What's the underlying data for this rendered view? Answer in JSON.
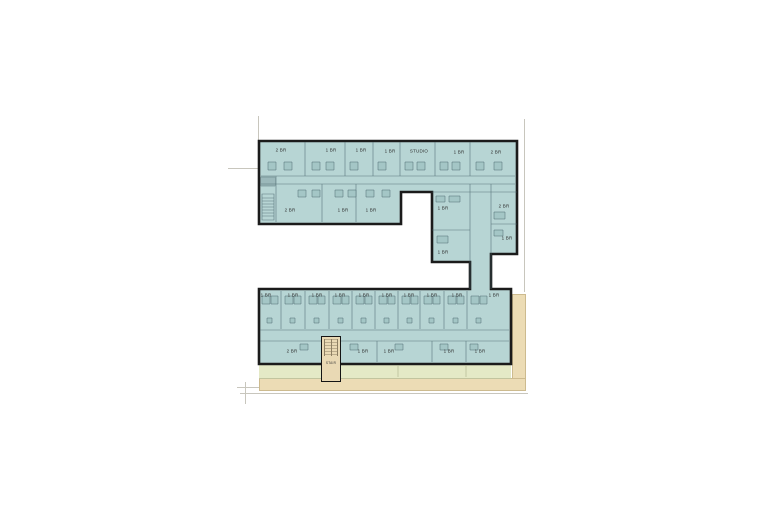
{
  "palette": {
    "unit": "#b7d5d4",
    "pod": "#a3c6c6",
    "wall": "#1b1b1b",
    "line": "#4a666d",
    "green": "#e4e9c6",
    "tan": "#ecdcb5",
    "stairTan": "#e9d9b4",
    "faint": "#c8c6bd",
    "label": "#2d2d2d"
  },
  "plan": {
    "stair": {
      "label": "STAIR",
      "x": 331,
      "y": 366
    },
    "units": [
      {
        "label": "2 BR",
        "row": "upper-north",
        "x": 281,
        "y": 150
      },
      {
        "label": "1 BR",
        "row": "upper-north",
        "x": 331,
        "y": 150
      },
      {
        "label": "1 BR",
        "row": "upper-north",
        "x": 361,
        "y": 150
      },
      {
        "label": "1 BR",
        "row": "upper-north",
        "x": 390,
        "y": 151
      },
      {
        "label": "STUDIO",
        "row": "upper-north",
        "x": 419,
        "y": 151
      },
      {
        "label": "1 BR",
        "row": "upper-north",
        "x": 459,
        "y": 152
      },
      {
        "label": "2 BR",
        "row": "upper-north",
        "x": 496,
        "y": 152
      },
      {
        "label": "2 BR",
        "row": "upper-south",
        "x": 290,
        "y": 210
      },
      {
        "label": "1 BR",
        "row": "upper-south",
        "x": 343,
        "y": 210
      },
      {
        "label": "1 BR",
        "row": "upper-south",
        "x": 371,
        "y": 210
      },
      {
        "label": "1 BR",
        "row": "east-wing",
        "x": 443,
        "y": 208
      },
      {
        "label": "2 BR",
        "row": "east-wing",
        "x": 504,
        "y": 206
      },
      {
        "label": "1 BR",
        "row": "east-wing",
        "x": 507,
        "y": 238
      },
      {
        "label": "1 BR",
        "row": "east-wing",
        "x": 443,
        "y": 252
      },
      {
        "label": "1 BR",
        "row": "lower-north",
        "x": 266,
        "y": 295
      },
      {
        "label": "1 BR",
        "row": "lower-north",
        "x": 293,
        "y": 295
      },
      {
        "label": "1 BR",
        "row": "lower-north",
        "x": 317,
        "y": 295
      },
      {
        "label": "1 BR",
        "row": "lower-north",
        "x": 340,
        "y": 295
      },
      {
        "label": "1 BR",
        "row": "lower-north",
        "x": 364,
        "y": 295
      },
      {
        "label": "1 BR",
        "row": "lower-north",
        "x": 387,
        "y": 295
      },
      {
        "label": "1 BR",
        "row": "lower-north",
        "x": 409,
        "y": 295
      },
      {
        "label": "1 BR",
        "row": "lower-north",
        "x": 432,
        "y": 295
      },
      {
        "label": "1 BR",
        "row": "lower-north",
        "x": 457,
        "y": 295
      },
      {
        "label": "1 BR",
        "row": "lower-north",
        "x": 494,
        "y": 295
      },
      {
        "label": "2 BR",
        "row": "lower-south",
        "x": 292,
        "y": 351
      },
      {
        "label": "1 BR",
        "row": "lower-south",
        "x": 363,
        "y": 351
      },
      {
        "label": "1 BR",
        "row": "lower-south",
        "x": 389,
        "y": 351
      },
      {
        "label": "1 BR",
        "row": "lower-south",
        "x": 449,
        "y": 351
      },
      {
        "label": "1 BR",
        "row": "lower-south",
        "x": 480,
        "y": 351
      }
    ]
  }
}
